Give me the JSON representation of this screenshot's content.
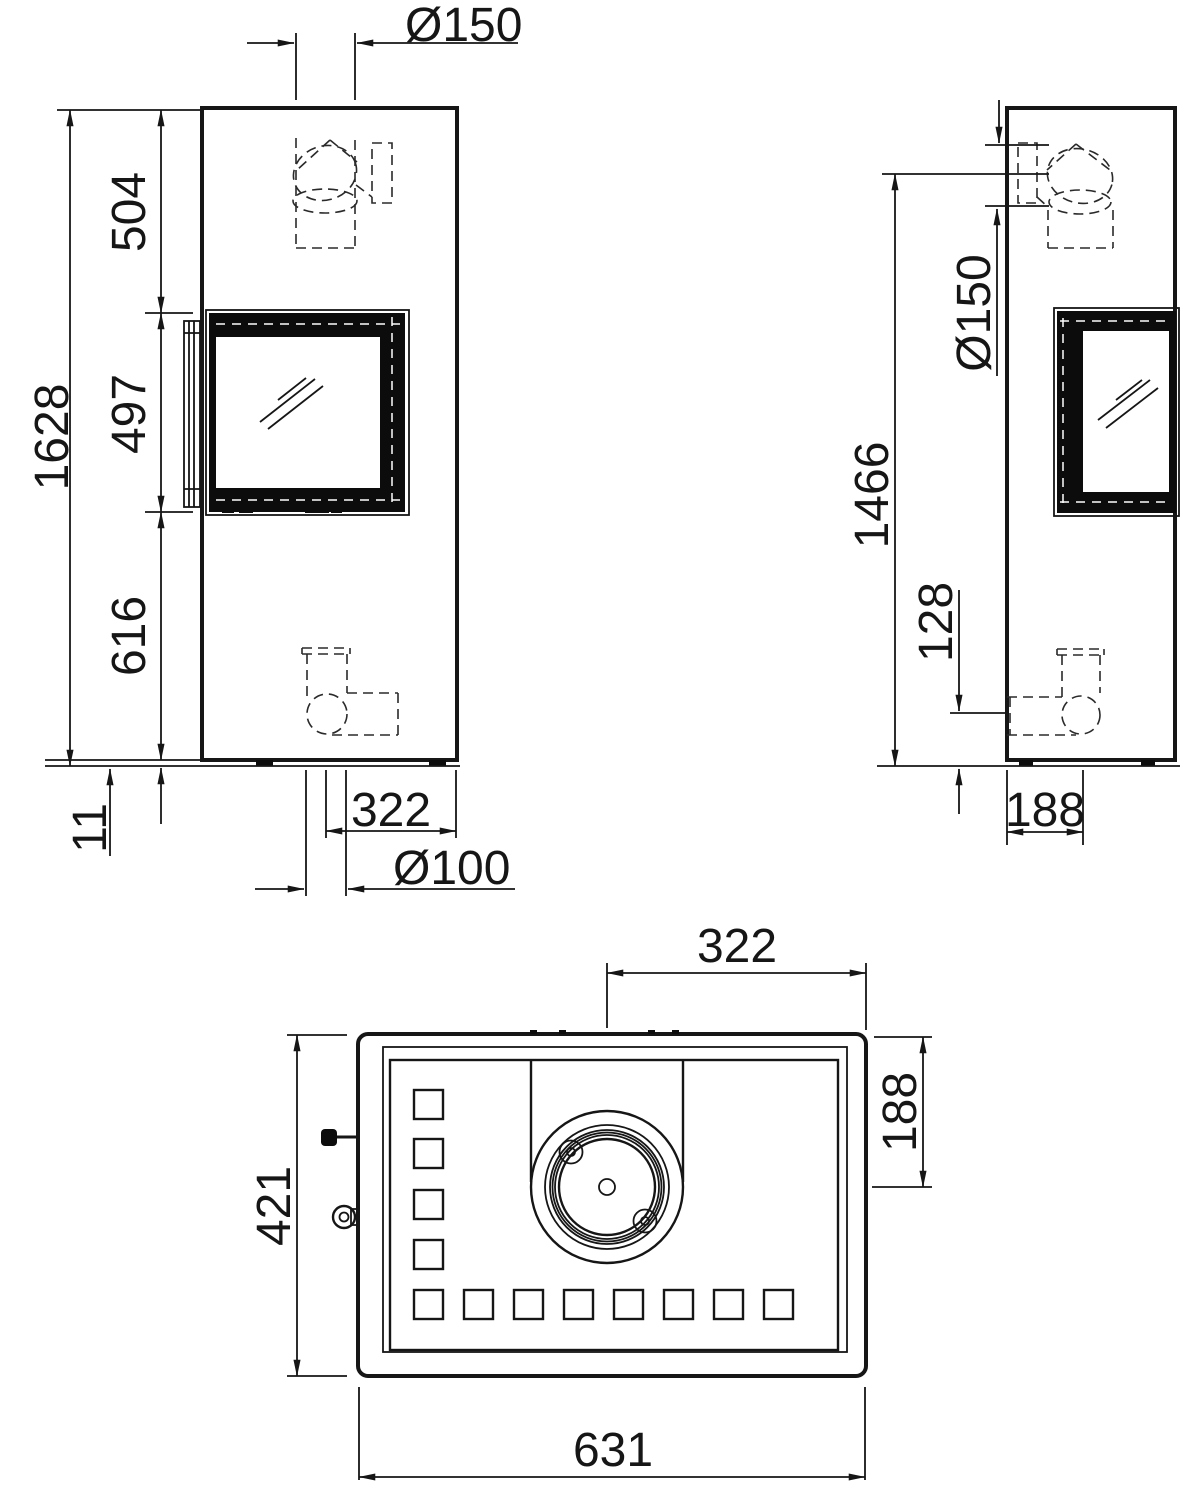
{
  "colors": {
    "background": "#ffffff",
    "line": "#161616"
  },
  "views": {
    "front": {
      "dims": {
        "flue_diameter": "Ø150",
        "overall_height": "1628",
        "top_to_window": "504",
        "window_height": "497",
        "window_to_base": "616",
        "base_height": "11",
        "flue_offset": "322",
        "rear_flue_diameter": "Ø100"
      }
    },
    "side": {
      "dims": {
        "flue_diameter": "Ø150",
        "flue_center_height": "1466",
        "rear_flue_center_height": "128",
        "flue_center_depth": "188"
      }
    },
    "top": {
      "dims": {
        "flue_offset": "322",
        "flue_center_depth": "188",
        "depth": "421",
        "width": "631"
      }
    }
  }
}
